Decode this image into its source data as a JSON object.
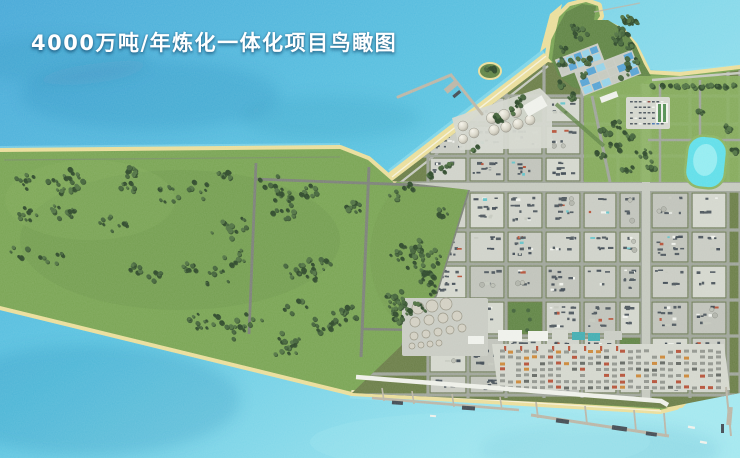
{
  "title": "4000万吨/年炼化一体化项目鸟瞰图",
  "scene": {
    "water_body": "sea",
    "land_features": [
      "forest-parcels",
      "industrial-grid",
      "sphere-tank-farm",
      "round-tank-farm",
      "container-yard",
      "water-treatment-ponds",
      "parking-lot",
      "lagoon",
      "hill-peninsula",
      "island"
    ],
    "marine_features": [
      "l-shaped-pier",
      "marginal-wharves",
      "boats"
    ]
  },
  "colors": {
    "water_deep": "#3fa5d6",
    "water_mid": "#54c2e0",
    "water_light": "#9fe7ef",
    "water_shadow": "#1a6ba0",
    "foam": "#f6f3df",
    "sand": "#e9dc96",
    "grass": "#73a04b",
    "grass_light": "#82ab55",
    "grass_dark": "#597f3c",
    "tree_dark": "#23401f",
    "tree_main": "#3a5c30",
    "tree_alt": "#486c39",
    "road": "#9aa095",
    "road_light": "#c2c6bb",
    "road_dark": "#767b72",
    "verge": "#64783f",
    "pad": "#c6c9c0",
    "pad_light": "#d2d5cb",
    "equip_dark": "#454f56",
    "equip_navy": "#37424c",
    "white_struct": "#eef0ea",
    "teal_unit": "#5fc0c6",
    "pond_blue": "#4f9fd2",
    "pond_light": "#8fd0e8",
    "lagoon": "#58dde8",
    "lagoon_light": "#a5f1f3",
    "tank": "#d0cdbf",
    "tank_line": "#93907f",
    "container_gray": "#8d9189",
    "container_dark": "#5d625c",
    "container_red": "#b24a2f",
    "container_orange": "#c9822f",
    "pier": "#b7b2a2",
    "boat_dark": "#3a434b",
    "white_road": "#edefe7",
    "title_color": "#ffffff"
  }
}
